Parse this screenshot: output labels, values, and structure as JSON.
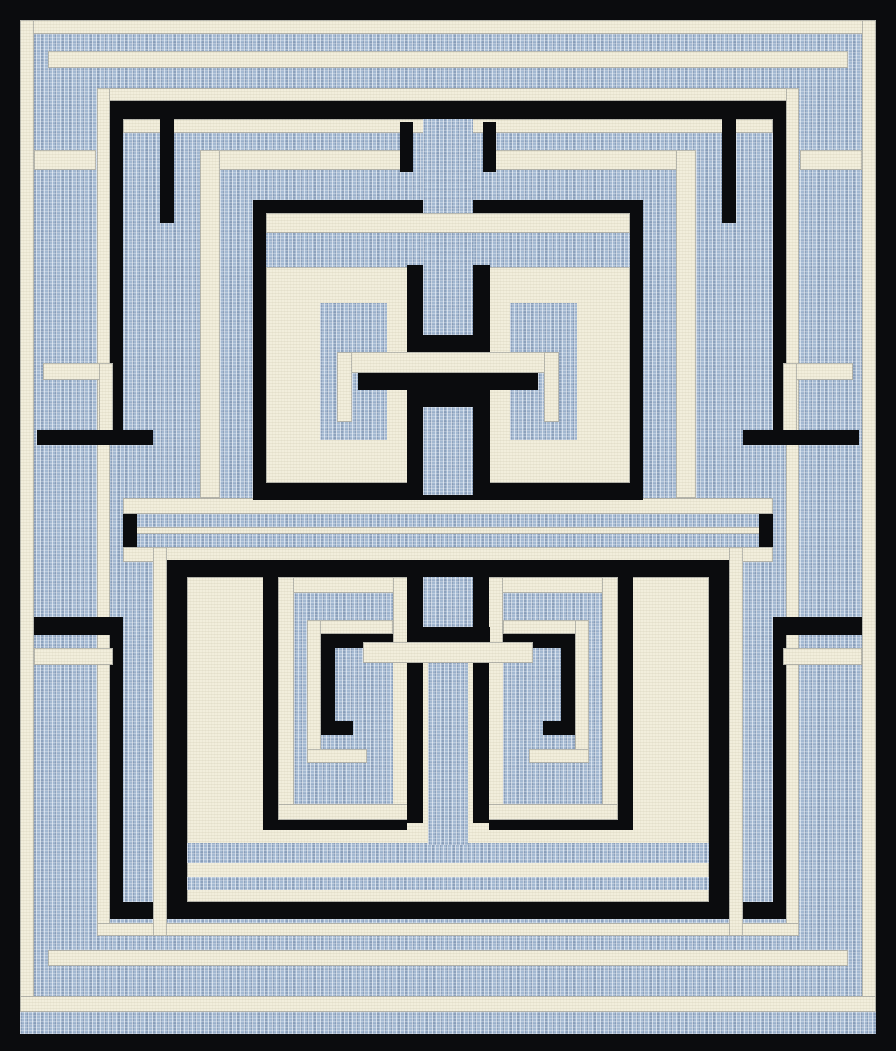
{
  "artwork": {
    "name": "labyrinth-maze-area-rug",
    "canvas": {
      "width": 896,
      "height": 1051
    },
    "palette": {
      "black": "#0b0c0e",
      "cream": "#f2eedc",
      "blue": "#a3b8d1",
      "blue_shadow": "#697e9c",
      "cream_edge": "#37414f"
    },
    "shapes": [
      [
        "frame",
        "K",
        0,
        0,
        896,
        1051
      ],
      [
        "field",
        "B",
        20,
        20,
        856,
        1014
      ],
      [
        "frame-line-top",
        "C",
        20,
        20,
        856,
        14
      ],
      [
        "frame-line-left",
        "C",
        20,
        20,
        14,
        992
      ],
      [
        "frame-line-right",
        "C",
        862,
        20,
        14,
        992
      ],
      [
        "frame-line-bottom",
        "C",
        20,
        996,
        856,
        16
      ],
      [
        "tick-ring-top",
        "C",
        48,
        51,
        800,
        17
      ],
      [
        "tick-ring-bottom",
        "C",
        48,
        950,
        800,
        16
      ],
      [
        "inner-ring-top",
        "C",
        97,
        88,
        702,
        13
      ],
      [
        "inner-ring-left",
        "C",
        97,
        88,
        13,
        848
      ],
      [
        "inner-ring-right",
        "C",
        786,
        88,
        13,
        848
      ],
      [
        "inner-ring-bottom",
        "C",
        97,
        923,
        702,
        13
      ],
      [
        "black-ring-top",
        "K",
        110,
        101,
        676,
        18
      ],
      [
        "black-ring-left-upper",
        "K",
        110,
        101,
        13,
        344
      ],
      [
        "black-ring-right-upper",
        "K",
        773,
        101,
        13,
        344
      ],
      [
        "black-ring-left-lower",
        "K",
        110,
        617,
        13,
        302
      ],
      [
        "black-ring-right-lower",
        "K",
        773,
        617,
        13,
        302
      ],
      [
        "black-ring-bottom",
        "K",
        110,
        902,
        676,
        17
      ],
      [
        "notch-cream-left-upper",
        "C",
        34,
        150,
        62,
        20
      ],
      [
        "notch-cream-right-upper",
        "C",
        800,
        150,
        62,
        20
      ],
      [
        "hook-cream-left-h",
        "C",
        43,
        363,
        70,
        17
      ],
      [
        "hook-cream-left-v",
        "C",
        99,
        363,
        14,
        74
      ],
      [
        "hook-cream-right-h",
        "C",
        783,
        363,
        70,
        17
      ],
      [
        "hook-cream-right-v",
        "C",
        783,
        363,
        14,
        74
      ],
      [
        "bar-black-left",
        "K",
        37,
        430,
        116,
        15
      ],
      [
        "bar-black-right",
        "K",
        743,
        430,
        116,
        15
      ],
      [
        "tick-black-left",
        "K",
        34,
        617,
        76,
        18
      ],
      [
        "tick-black-right",
        "K",
        786,
        617,
        76,
        18
      ],
      [
        "tick-cream-left",
        "C",
        34,
        648,
        79,
        17
      ],
      [
        "tick-cream-right",
        "C",
        783,
        648,
        79,
        17
      ],
      [
        "corridor-cream-top",
        "C",
        123,
        498,
        650,
        16
      ],
      [
        "corridor-cream-line",
        "C",
        123,
        527,
        650,
        7
      ],
      [
        "corridor-cream-bottom",
        "C",
        123,
        547,
        650,
        15
      ],
      [
        "corridor-black-left",
        "K",
        123,
        514,
        14,
        33
      ],
      [
        "corridor-black-right",
        "K",
        759,
        514,
        14,
        33
      ],
      [
        "tp-cream-band",
        "C",
        123,
        119,
        650,
        14
      ],
      [
        "tp-ringB-top-left",
        "C",
        200,
        150,
        213,
        20
      ],
      [
        "tp-ringB-top-right",
        "C",
        483,
        150,
        213,
        20
      ],
      [
        "tp-ringB-left",
        "C",
        200,
        150,
        20,
        348
      ],
      [
        "tp-ringB-right",
        "C",
        676,
        150,
        20,
        348
      ],
      [
        "tp-A2-left",
        "K",
        160,
        119,
        14,
        104
      ],
      [
        "tp-A2-right",
        "K",
        722,
        119,
        14,
        104
      ],
      [
        "tp-tick-left",
        "K",
        400,
        122,
        13,
        50
      ],
      [
        "tp-tick-right",
        "K",
        483,
        122,
        13,
        50
      ],
      [
        "tp-ringC-left",
        "K",
        253,
        200,
        13,
        300
      ],
      [
        "tp-ringC-right",
        "K",
        630,
        200,
        13,
        300
      ],
      [
        "tp-ringC-top-left",
        "K",
        253,
        200,
        170,
        13
      ],
      [
        "tp-ringC-top-right",
        "K",
        473,
        200,
        170,
        13
      ],
      [
        "tp-ringC-bottom",
        "K",
        253,
        483,
        390,
        17
      ],
      [
        "tp-cell",
        "C",
        266,
        267,
        364,
        216
      ],
      [
        "tp-block-left",
        "B",
        320,
        303,
        67,
        137
      ],
      [
        "tp-block-right",
        "B",
        510,
        303,
        67,
        137
      ],
      [
        "tp-column-top",
        "B",
        423,
        119,
        50,
        216
      ],
      [
        "tp-break-band",
        "C",
        266,
        213,
        364,
        20
      ],
      [
        "tp-h-flank-tl",
        "K",
        407,
        265,
        16,
        70
      ],
      [
        "tp-h-flank-tr",
        "K",
        473,
        265,
        17,
        70
      ],
      [
        "tp-h-cap-top",
        "K",
        407,
        335,
        83,
        17
      ],
      [
        "tp-h-bar",
        "K",
        358,
        373,
        180,
        17
      ],
      [
        "tp-h-cap-bottom",
        "K",
        407,
        390,
        83,
        17
      ],
      [
        "tp-h-flank-bl",
        "K",
        407,
        407,
        16,
        81
      ],
      [
        "tp-h-flank-br",
        "K",
        473,
        407,
        17,
        81
      ],
      [
        "tp-crossbar",
        "C",
        340,
        352,
        217,
        21
      ],
      [
        "tp-hook-left-v",
        "C",
        337,
        352,
        15,
        70
      ],
      [
        "tp-hook-right-v",
        "C",
        544,
        352,
        15,
        70
      ],
      [
        "tp-column-bottom",
        "B",
        423,
        407,
        50,
        88
      ],
      [
        "bp-R4-left",
        "C",
        153,
        547,
        14,
        389
      ],
      [
        "bp-R4-right",
        "C",
        729,
        547,
        14,
        389
      ],
      [
        "bp-outline-top",
        "K",
        167,
        560,
        562,
        17
      ],
      [
        "bp-outline-left",
        "K",
        167,
        560,
        20,
        359
      ],
      [
        "bp-outline-right",
        "K",
        709,
        560,
        20,
        359
      ],
      [
        "bp-cell",
        "C",
        187,
        577,
        522,
        325
      ],
      [
        "bp-band1",
        "B",
        187,
        843,
        522,
        20
      ],
      [
        "bp-band2",
        "B",
        187,
        877,
        522,
        13
      ],
      [
        "bp-U-left-v",
        "K",
        263,
        577,
        22,
        253
      ],
      [
        "bp-U-left-h",
        "K",
        263,
        813,
        144,
        17
      ],
      [
        "bp-U-right-v",
        "K",
        611,
        577,
        22,
        253
      ],
      [
        "bp-U-right-h",
        "K",
        489,
        813,
        144,
        17
      ],
      [
        "spiral-left-top",
        "C",
        278,
        577,
        131,
        16
      ],
      [
        "spiral-left-left",
        "C",
        278,
        577,
        16,
        243
      ],
      [
        "spiral-left-bottom",
        "C",
        278,
        804,
        131,
        16
      ],
      [
        "spiral-left-stub",
        "C",
        393,
        577,
        16,
        77
      ],
      [
        "spiral-left-core",
        "B",
        294,
        593,
        99,
        211
      ],
      [
        "spiral-left-inner-top",
        "C",
        307,
        620,
        86,
        14
      ],
      [
        "spiral-left-inner-left",
        "C",
        307,
        620,
        14,
        143
      ],
      [
        "spiral-left-inner-bottom",
        "C",
        307,
        749,
        60,
        14
      ],
      [
        "spiral-left-k-v",
        "K",
        321,
        634,
        14,
        101
      ],
      [
        "spiral-left-k-h",
        "K",
        335,
        634,
        58,
        14
      ],
      [
        "spiral-left-k-hook",
        "K",
        321,
        721,
        32,
        14
      ],
      [
        "spiral-right-top",
        "C",
        487,
        577,
        131,
        16
      ],
      [
        "spiral-right-right",
        "C",
        602,
        577,
        16,
        243
      ],
      [
        "spiral-right-bottom",
        "C",
        487,
        804,
        131,
        16
      ],
      [
        "spiral-right-stub",
        "C",
        487,
        577,
        16,
        77
      ],
      [
        "spiral-right-core",
        "B",
        503,
        593,
        99,
        211
      ],
      [
        "spiral-right-inner-top",
        "C",
        503,
        620,
        86,
        14
      ],
      [
        "spiral-right-inner-right",
        "C",
        575,
        620,
        14,
        143
      ],
      [
        "spiral-right-inner-bottom",
        "C",
        529,
        749,
        60,
        14
      ],
      [
        "spiral-right-k-v",
        "K",
        561,
        634,
        14,
        101
      ],
      [
        "spiral-right-k-h",
        "K",
        503,
        634,
        58,
        14
      ],
      [
        "spiral-right-k-hook",
        "K",
        543,
        721,
        32,
        14
      ],
      [
        "bp-bridge",
        "C",
        363,
        642,
        170,
        21
      ],
      [
        "bp-T-head",
        "B",
        423,
        577,
        50,
        50
      ],
      [
        "bp-T-flank-left",
        "K",
        407,
        577,
        16,
        65
      ],
      [
        "bp-T-flank-right",
        "K",
        473,
        577,
        16,
        65
      ],
      [
        "bp-T-bar",
        "K",
        407,
        627,
        83,
        15
      ],
      [
        "bp-stem",
        "B",
        428,
        663,
        40,
        182
      ],
      [
        "bp-stem-flank-left",
        "K",
        407,
        663,
        16,
        160
      ],
      [
        "bp-stem-flank-right",
        "K",
        473,
        663,
        16,
        160
      ]
    ]
  }
}
